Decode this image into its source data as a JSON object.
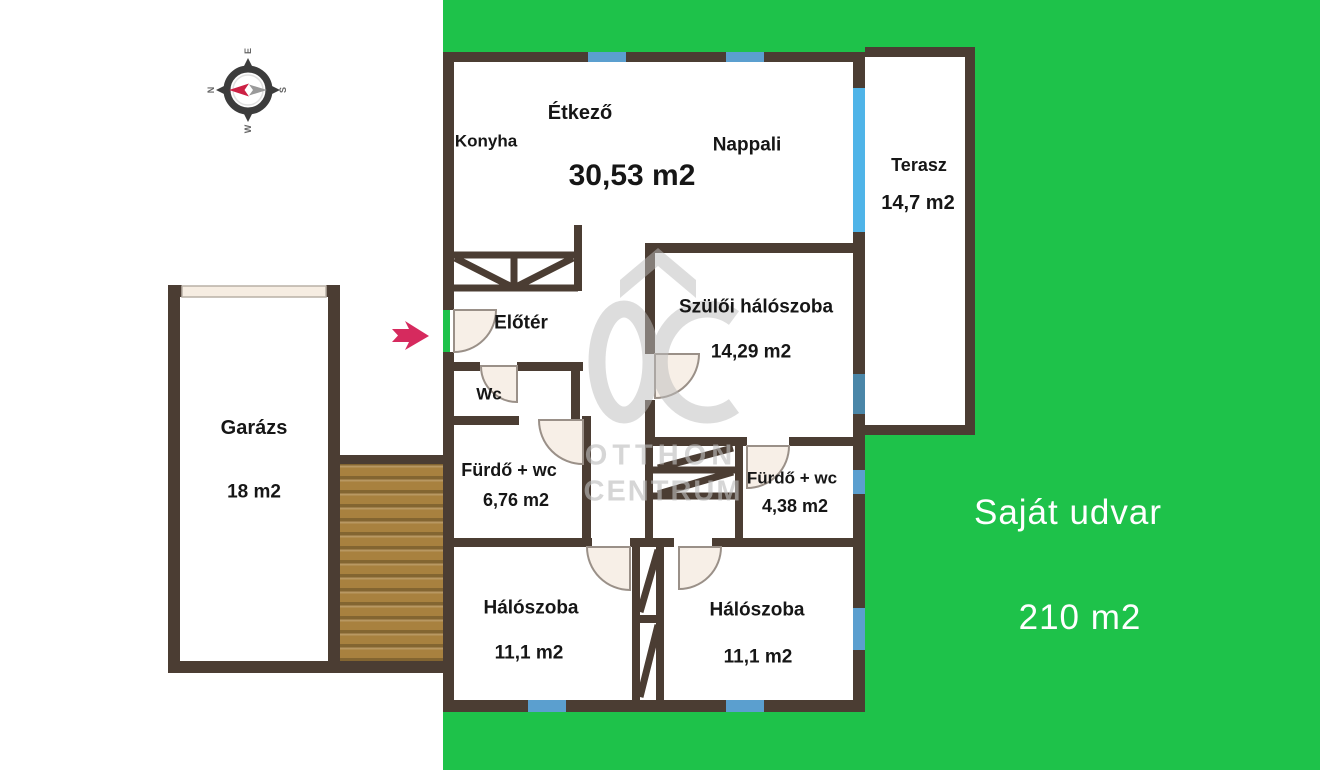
{
  "plan": {
    "rooms": {
      "etkezo": {
        "label": "Étkező"
      },
      "konyha": {
        "label": "Konyha"
      },
      "nappali": {
        "label": "Nappali"
      },
      "living_area": "30,53 m2",
      "terasz": {
        "label": "Terasz",
        "area": "14,7 m2"
      },
      "szuloi_haloszoba": {
        "label": "Szülői hálószoba",
        "area": "14,29 m2"
      },
      "eloter": {
        "label": "Előtér"
      },
      "wc": {
        "label": "Wc"
      },
      "furdo_1": {
        "label": "Fürdő + wc",
        "area": "6,76 m2"
      },
      "furdo_2": {
        "label": "Fürdő + wc",
        "area": "4,38 m2"
      },
      "haloszoba_1": {
        "label": "Hálószoba",
        "area": "11,1 m2"
      },
      "haloszoba_2": {
        "label": "Hálószoba",
        "area": "11,1 m2"
      },
      "garazs": {
        "label": "Garázs",
        "area": "18 m2"
      }
    },
    "yard": {
      "label": "Saját udvar",
      "area": "210 m2"
    },
    "compass": {
      "n": "N",
      "e": "E",
      "s": "S",
      "w": "W"
    },
    "watermark": {
      "line1": "OTTHON",
      "line2": "CENTRUM"
    },
    "colors": {
      "green": "#1ec24a",
      "wall": "#4b3d33",
      "win": "#5b9fcf",
      "win_big": "#4fb4e8",
      "win_dark": "#4a86a8",
      "door": "#f7efe7",
      "wood": "#a8813f",
      "arrow": "#d62a5e",
      "wm": "#bdbdbd"
    }
  }
}
